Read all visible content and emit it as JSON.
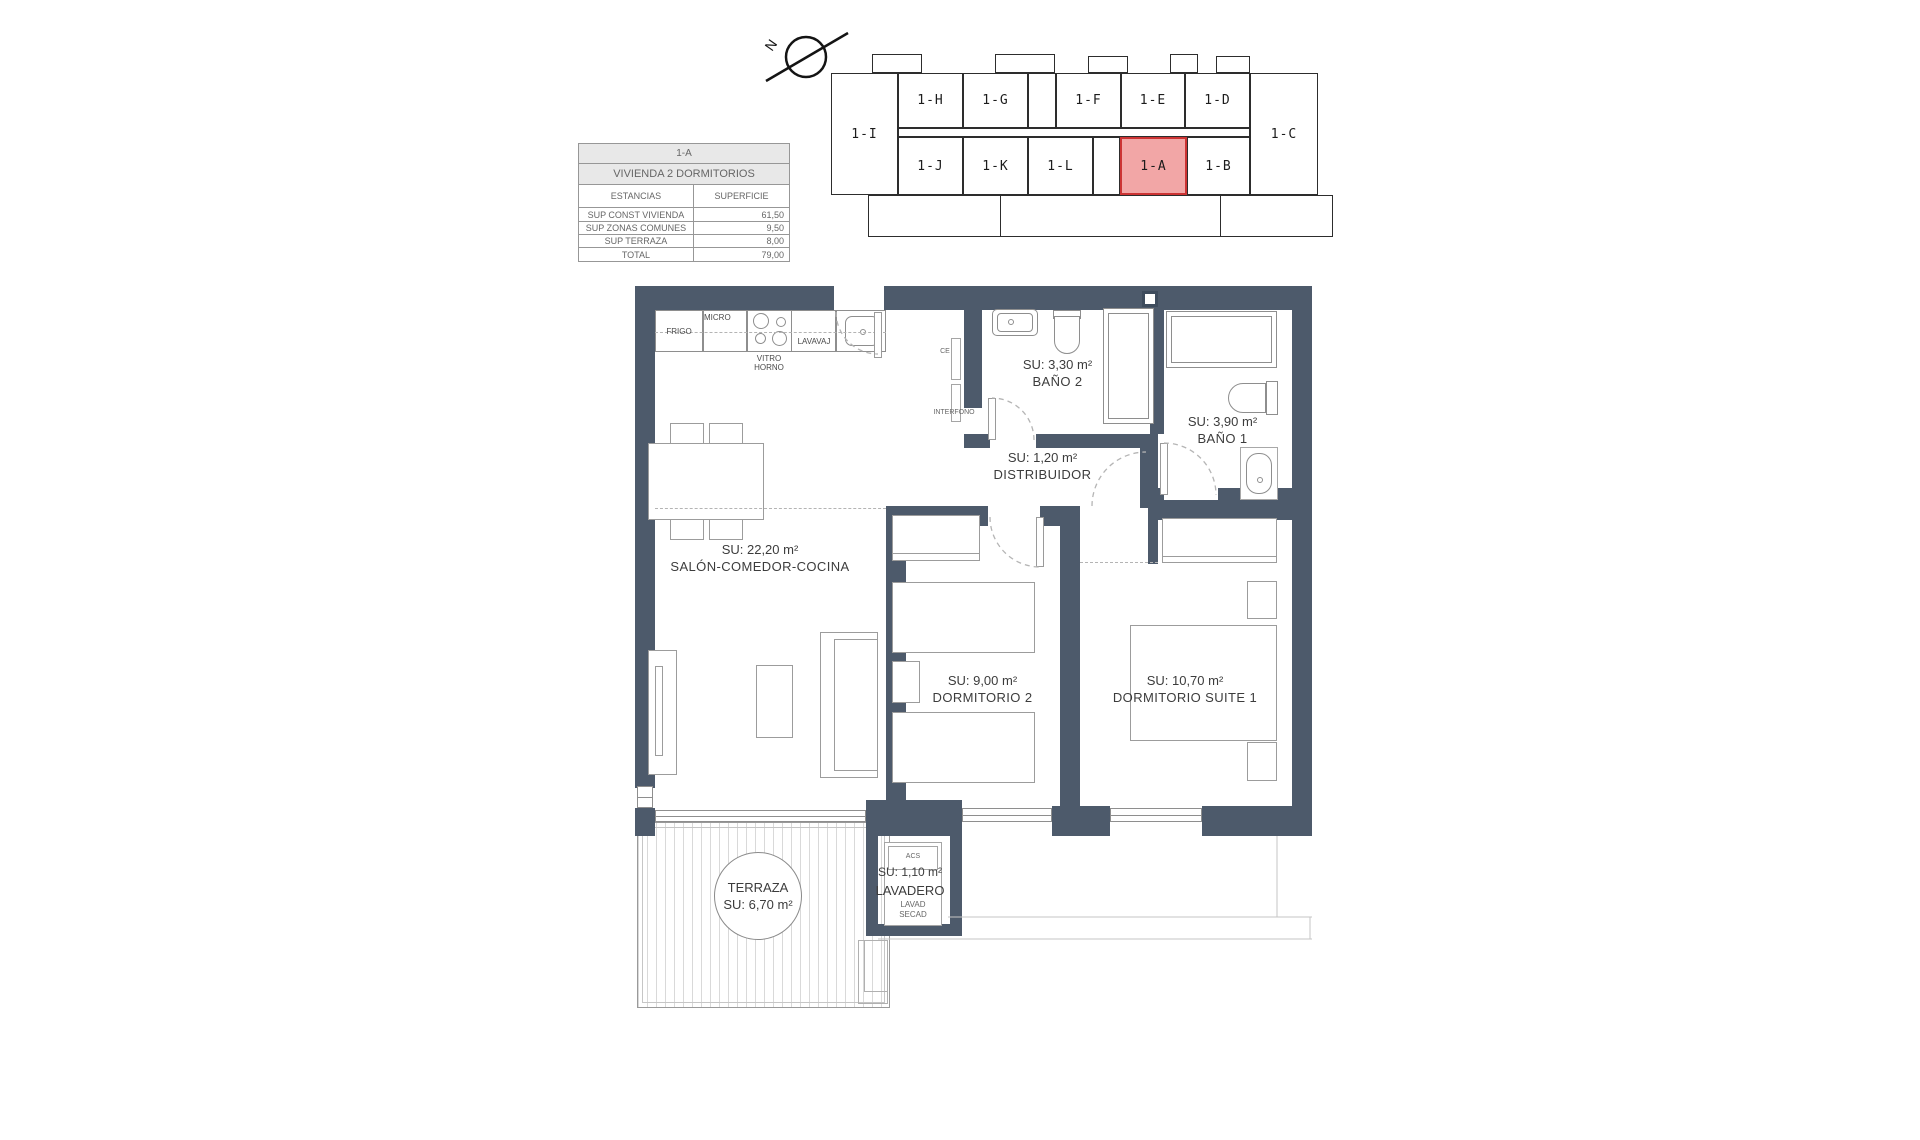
{
  "compass": {
    "letter": "N"
  },
  "info_table": {
    "title": "1-A",
    "subtitle": "VIVIENDA 2 DORMITORIOS",
    "col1": "ESTANCIAS",
    "col2": "SUPERFICIE",
    "rows": [
      {
        "label": "SUP CONST VIVIENDA",
        "value": "61,50"
      },
      {
        "label": "SUP ZONAS COMUNES",
        "value": "9,50"
      },
      {
        "label": "SUP TERRAZA",
        "value": "8,00"
      },
      {
        "label": "TOTAL",
        "value": "79,00"
      }
    ]
  },
  "key_plan": {
    "highlighted": "1-A",
    "units": [
      {
        "label": "1-I"
      },
      {
        "label": "1-H"
      },
      {
        "label": "1-G"
      },
      {
        "label": "1-F"
      },
      {
        "label": "1-E"
      },
      {
        "label": "1-D"
      },
      {
        "label": "1-C"
      },
      {
        "label": "1-J"
      },
      {
        "label": "1-K"
      },
      {
        "label": "1-L"
      },
      {
        "label": "1-A"
      },
      {
        "label": "1-B"
      }
    ]
  },
  "rooms": {
    "salon": {
      "area": "SU: 22,20 m²",
      "name": "SALÓN-COMEDOR-COCINA"
    },
    "bano2": {
      "area": "SU: 3,30 m²",
      "name": "BAÑO 2"
    },
    "bano1": {
      "area": "SU: 3,90 m²",
      "name": "BAÑO 1"
    },
    "distribuidor": {
      "area": "SU: 1,20 m²",
      "name": "DISTRIBUIDOR"
    },
    "dormitorio2": {
      "area": "SU: 9,00 m²",
      "name": "DORMITORIO 2"
    },
    "suite": {
      "area": "SU: 10,70 m²",
      "name": "DORMITORIO SUITE 1"
    },
    "terraza": {
      "name": "TERRAZA",
      "area": "SU: 6,70 m²"
    },
    "lavadero": {
      "area": "SU: 1,10 m²",
      "name": "LAVADERO",
      "acs": "ACS",
      "lavad": "LAVAD",
      "secad": "SECAD"
    }
  },
  "kitchen": {
    "frigo": "FRIGO",
    "micro": "MICRO",
    "vitro": "VITRO",
    "horno": "HORNO",
    "lavavaj": "LAVAVAJ"
  },
  "annotations": {
    "ce": "CE",
    "interfono": "INTERFONO"
  },
  "colors": {
    "wall": "#4d5a6b",
    "highlight_fill": "#f2a6a6",
    "highlight_border": "#cc3333"
  }
}
